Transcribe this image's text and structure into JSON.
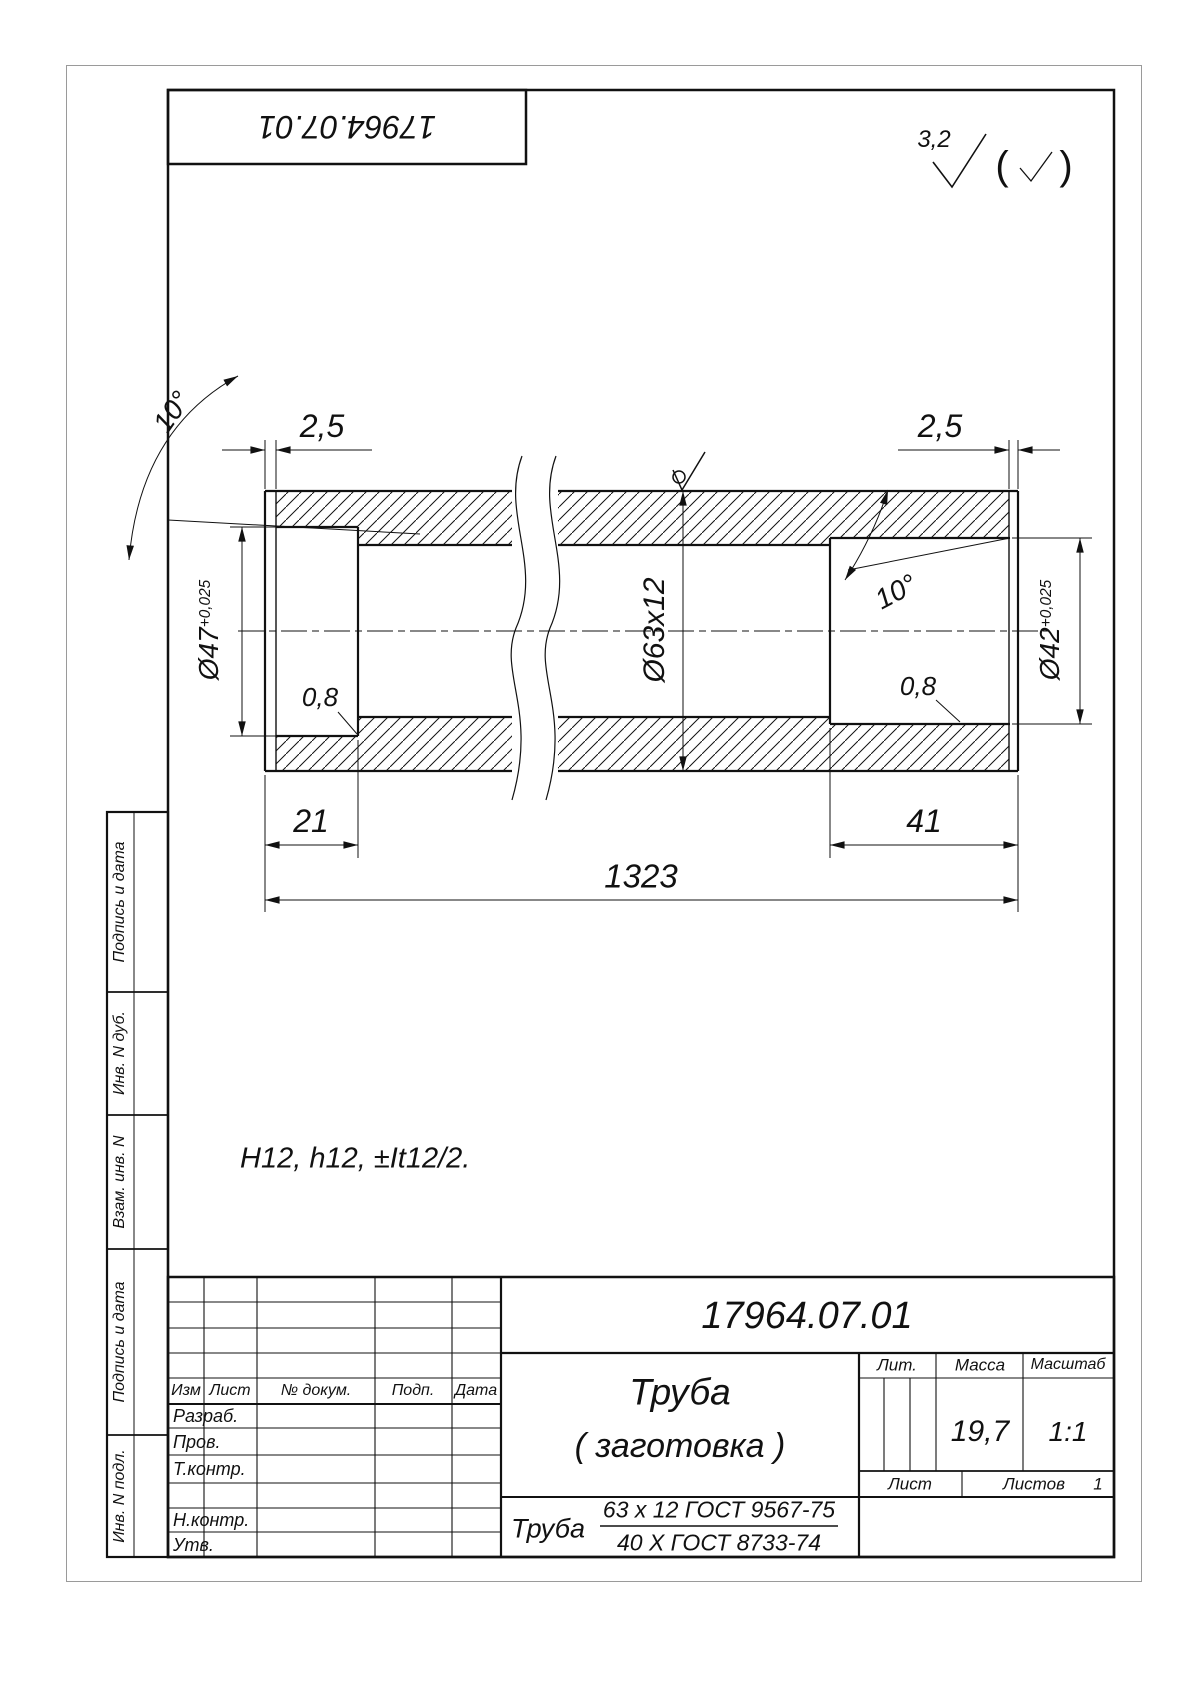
{
  "sheet": {
    "stamp_number": "17964.07.01",
    "roughness": {
      "value": "3,2",
      "paren_open": "(",
      "paren_close": ")"
    },
    "note": "H12, h12, ±It12/2."
  },
  "dims": {
    "end_width_left": "2,5",
    "end_width_right": "2,5",
    "angle_left": "10°",
    "angle_right": "10°",
    "bore_left": "Ø47",
    "bore_left_tol": "+0,025",
    "bore_right": "Ø42",
    "bore_right_tol": "+0,025",
    "tube": "Ø63x12",
    "chamfer_left": "0,8",
    "chamfer_right": "0,8",
    "depth_left": "21",
    "depth_right": "41",
    "length": "1323"
  },
  "title_block": {
    "doc_number": "17964.07.01",
    "part_name": "Труба",
    "part_name_2": "( заготовка )",
    "material_prefix": "Труба",
    "material_top": "63 x 12 ГОСТ 9567-75",
    "material_bottom": "40 Х ГОСТ 8733-74",
    "col_izm": "Изм",
    "col_list": "Лист",
    "col_dokum": "№ докум.",
    "col_podp": "Подп.",
    "col_data": "Дата",
    "row_razrab": "Разраб.",
    "row_prov": "Пров.",
    "row_tkontr": "Т.контр.",
    "row_nkontr": "Н.контр.",
    "row_utv": "Утв.",
    "lit": "Лит.",
    "massa": "Масса",
    "masshtab": "Масштаб",
    "massa_value": "19,7",
    "masshtab_value": "1:1",
    "list": "Лист",
    "listov": "Листов",
    "listov_value": "1"
  },
  "side_column": {
    "podpis_1": "Подпись и дата",
    "inv_dub": "Инв. N дуб.",
    "vzam_inv": "Взам. инв. N",
    "podpis_2": "Подпись и дата",
    "inv_podl": "Инв. N подл."
  }
}
